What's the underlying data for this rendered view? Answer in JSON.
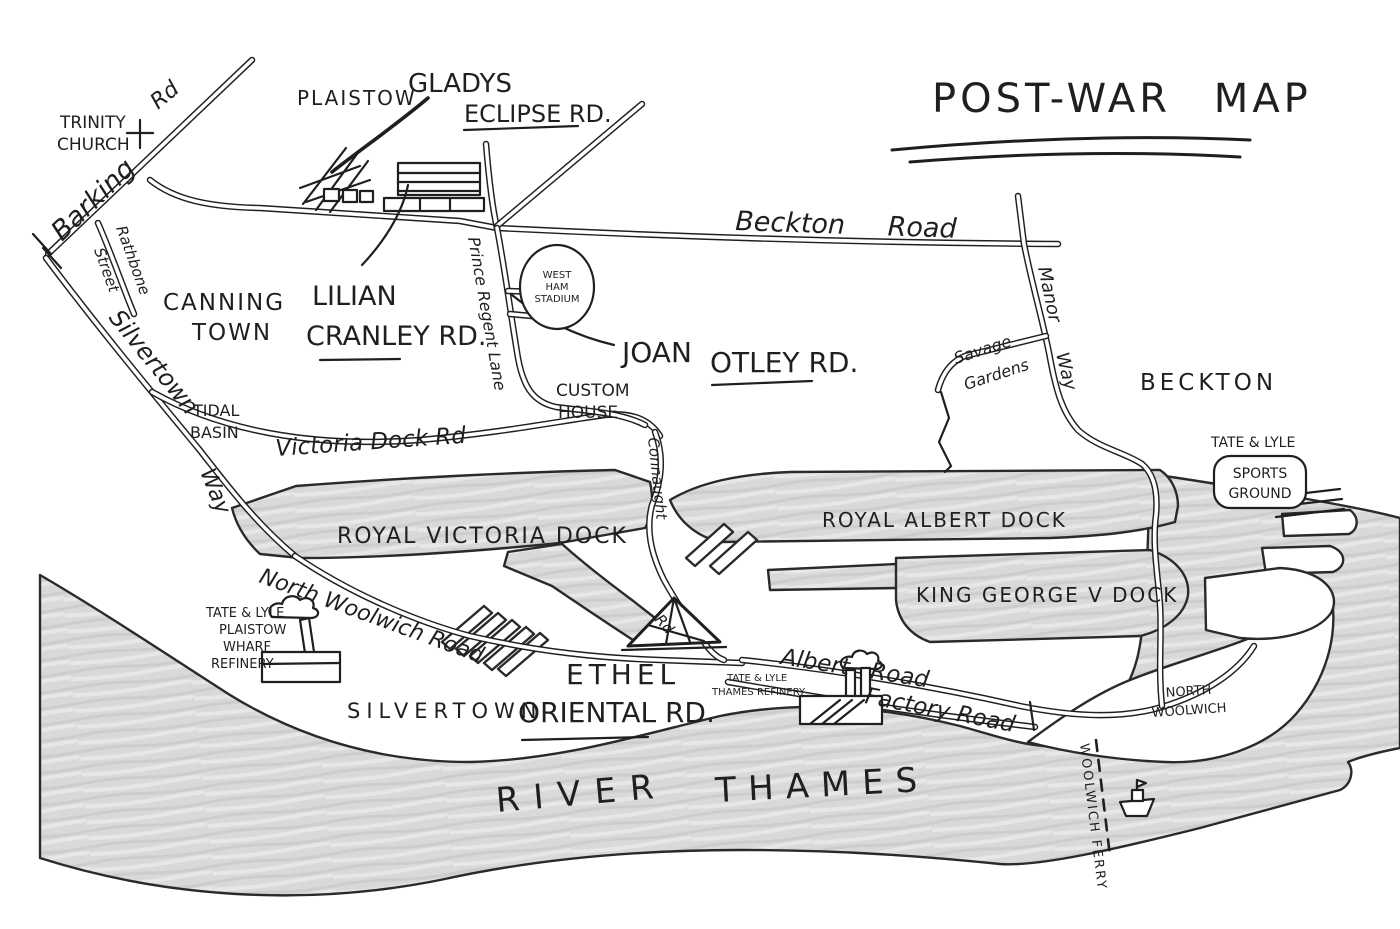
{
  "colors": {
    "ink": "#1f1f1f",
    "water": "#d9d9d9",
    "paper": "#ffffff"
  },
  "title": "POST-WAR MAP",
  "areas": {
    "plaistow": "PLAISTOW",
    "canning_town": [
      "CANNING",
      "TOWN"
    ],
    "tidal_basin": [
      "TIDAL",
      "BASIN"
    ],
    "custom_house": [
      "CUSTOM",
      "HOUSE"
    ],
    "beckton": "BECKTON",
    "silvertown": "SILVERTOWN",
    "north_woolwich": [
      "NORTH",
      "WOOLWICH"
    ]
  },
  "roads": {
    "barking": [
      "Barking",
      "Rd"
    ],
    "rathbone": [
      "Rathbone",
      "Street"
    ],
    "eclipse": [
      "GLADYS",
      "ECLIPSE RD."
    ],
    "cranley": [
      "LILIAN",
      "CRANLEY RD."
    ],
    "prince_regent": "Prince Regent Lane",
    "beckton_road": "Beckton Road",
    "otley": [
      "JOAN",
      "OTLEY RD."
    ],
    "silvertown_way": [
      "Silvertown",
      "Way"
    ],
    "victoria_dock": "Victoria Dock Rd",
    "savage_gardens": [
      "Savage",
      "Gardens"
    ],
    "manor_way": [
      "Manor",
      "Way"
    ],
    "connaught": [
      "Connaught",
      "Rd"
    ],
    "north_woolwich_road": "North Woolwich Road",
    "albert_road": "Albert Road",
    "factory_road": "Factory Road",
    "ethel": [
      "ETHEL",
      "ORIENTAL RD."
    ]
  },
  "docks": {
    "royal_victoria": "ROYAL VICTORIA DOCK",
    "royal_albert": "ROYAL ALBERT DOCK",
    "king_george": "KING GEORGE V DOCK"
  },
  "places": {
    "trinity_church": [
      "TRINITY",
      "CHURCH"
    ],
    "west_ham_stadium": [
      "WEST",
      "HAM",
      "STADIUM"
    ],
    "tate_sports": [
      "TATE & LYLE",
      "SPORTS",
      "GROUND"
    ],
    "tate_plaistow": [
      "TATE & LYLE",
      "PLAISTOW",
      "WHARF",
      "REFINERY"
    ],
    "tate_thames": [
      "TATE & LYLE",
      "THAMES REFINERY"
    ]
  },
  "water_labels": {
    "river": [
      "RIVER",
      "THAMES"
    ],
    "ferry": "WOOLWICH FERRY"
  }
}
